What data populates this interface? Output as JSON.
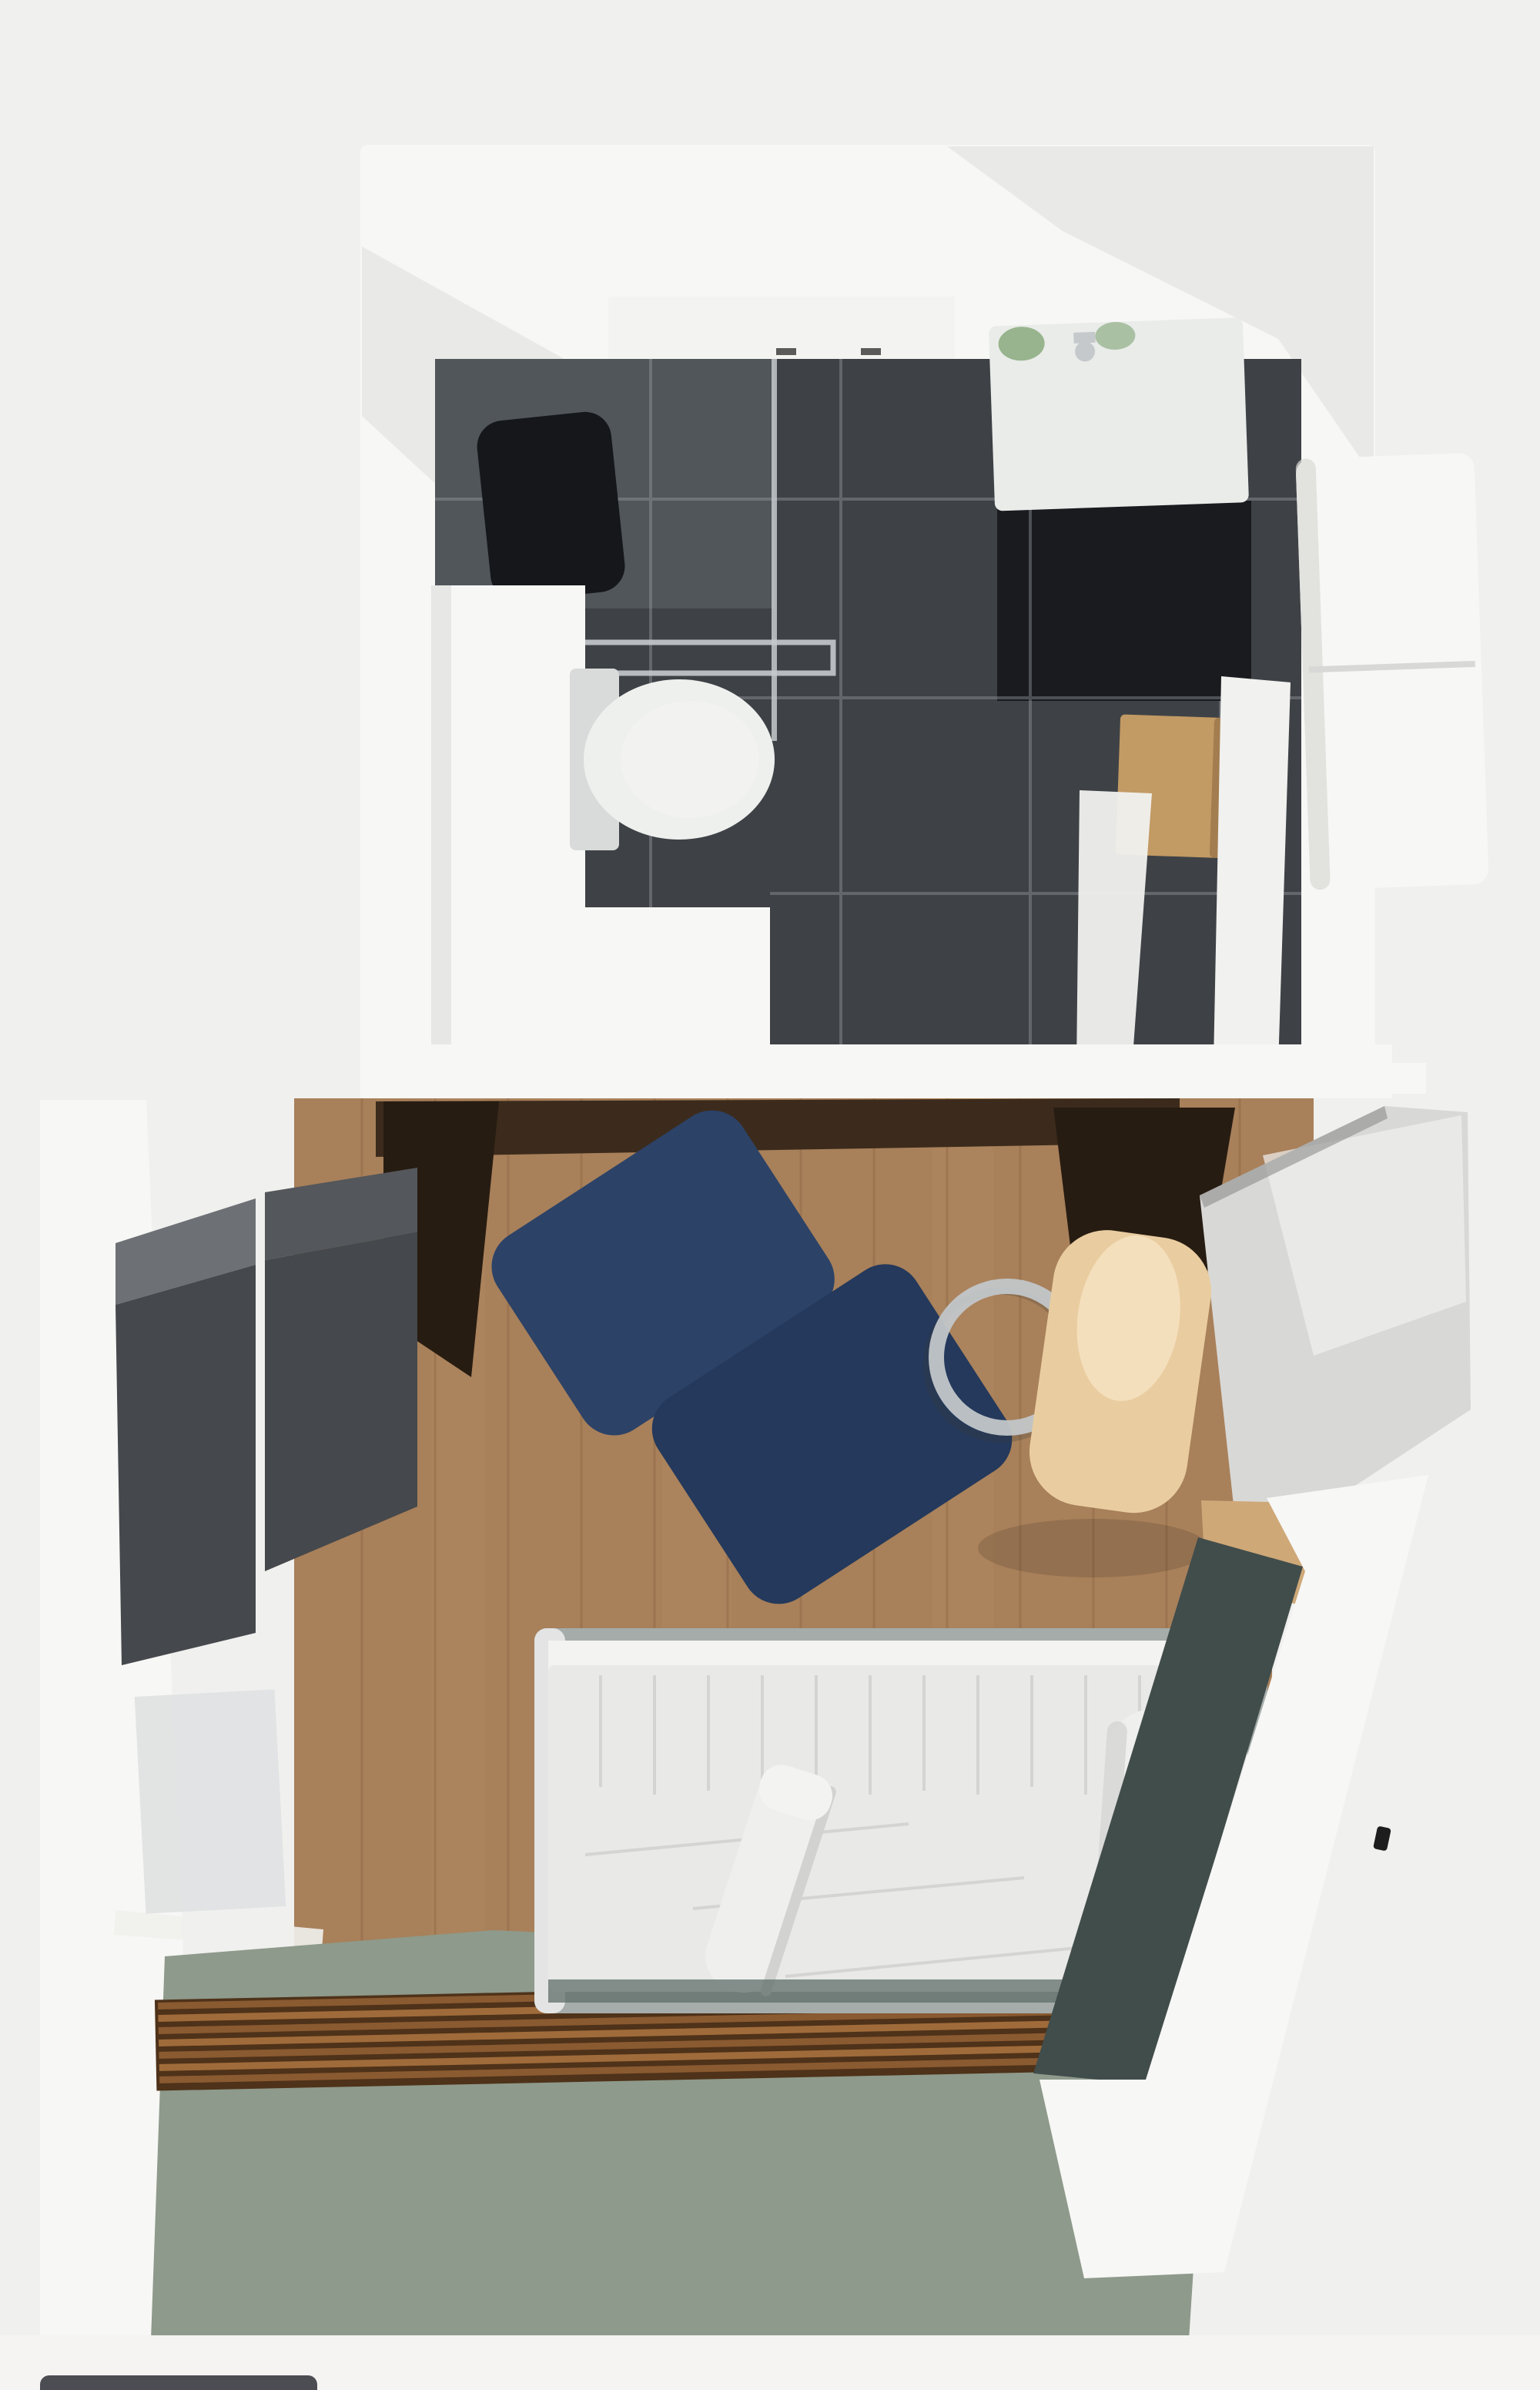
{
  "scene": {
    "description": "Top-down 3D reconstruction scan of a studio apartment: bathroom with dark tile floor (top), bedroom with wooden floor, bed and green floor area (bottom)"
  },
  "objects": {
    "scene": "apartment-top-down-scan",
    "bathroom": "bathroom",
    "bathroomWalls": "bathroom white walls",
    "bathroomFloor": "dark tile bathroom floor",
    "shower": "shower area",
    "showerHole": "dark scan hole in shower",
    "showerGlass": "glass shower partition",
    "towelRail": "chrome towel rail",
    "toilet": "white toilet",
    "cistern": "toilet cistern",
    "sink": "white sink vanity",
    "faucet": "faucet",
    "plant": "green plants on sink",
    "cabinetBand": "white wall cabinet",
    "stool": "wooden stool",
    "towelDoor": "white towel on door",
    "towelFloor": "white towel on floor",
    "bench": "white bench outside wall",
    "divider": "dividing wall with doorway",
    "bedroom": "bedroom",
    "woodFloor": "wooden plank floor",
    "shelf": "dark brown shelf band",
    "shelfCorner": "dark brown cabinet corner",
    "loungeChair": "navy blue lounge cushions",
    "wardrobe": "dark gray wardrobe",
    "poster": "poster on wall",
    "deskBackdrop": "dark area behind desk chair",
    "deskPanel": "silver wardrobe panel",
    "deskEdge": "tan desk edge",
    "chromeBase": "chrome chair ring base",
    "deskChair": "tan desk chair seat",
    "bed": "bed with white duvet",
    "bedFrame": "bed frame",
    "duvet": "white duvet",
    "sheetBand": "white sheet band",
    "towelRoll": "rolled towel on bed",
    "pillow": "white bolster pillow",
    "bedFoot": "bed foot edge",
    "sidePanel": "dark teal side panel",
    "leftWall": "left white wall",
    "rightWall": "right white wall",
    "hook": "black wall hook",
    "baseboard": "white baseboard",
    "greenFloor": "sage green floor",
    "slatMat": "wooden slat mat",
    "bottomBand": "bottom white band",
    "darkBar": "dark object at bottom edge"
  },
  "colors": {
    "bg": "#f0f0ee",
    "wall": "#f7f7f5",
    "wallShade": "#d8d8d6",
    "cabinetBand": "#f3f3f1",
    "handle": "#5a5a58",
    "tile": "#3e4246",
    "tileDark": "#15171b",
    "slate": "#51565b",
    "grout": "#9aa0a4",
    "chrome": "#c5c9cc",
    "porcelain": "#eef0ee",
    "porcelainShade": "#d8dbd9",
    "vanity": "#e9ece9",
    "plant": "#8fae84",
    "stool": "#c29a63",
    "stoolShade": "#8d6b42",
    "towel": "#f1f1ef",
    "wood": "#a8805a",
    "woodDark": "#846240",
    "woodLight": "#bb9167",
    "shelf": "#3c2b1c",
    "shelfDark": "#271c12",
    "navy1": "#2c4267",
    "navy2": "#24395b",
    "wardrobe": "#45484c",
    "wardrobeTop": "#6d7175",
    "wardrobeLight": "#54575b",
    "poster": "#dfe1e2",
    "silver": "#d8d8d6",
    "silverHi": "#f1f1ef",
    "silverEdge": "#8e8e8c",
    "deskTan": "#cfa878",
    "seat": "#e9cda0",
    "seatHi": "#f6e4c4",
    "ring": "#c2c6c9",
    "ringShadow": "#3a3a38",
    "bedFrame": "#a5aca9",
    "duvet": "#e9e9e7",
    "duvetShade": "#d2d2d0",
    "sheet": "#f3f3f1",
    "pillow": "#efefed",
    "bedFoot": "#5f6d69",
    "teal": "#414d4b",
    "green": "#8e9a8b",
    "baseboard": "#f0f0ed",
    "bottomBand": "#f5f4f2",
    "slatBase": "#4e3219",
    "slat": "#8a5a31",
    "slatHi": "#a06b3a",
    "darkBar": "#4c4c53",
    "hook": "#1d1d1d",
    "shadow": "#000000"
  }
}
